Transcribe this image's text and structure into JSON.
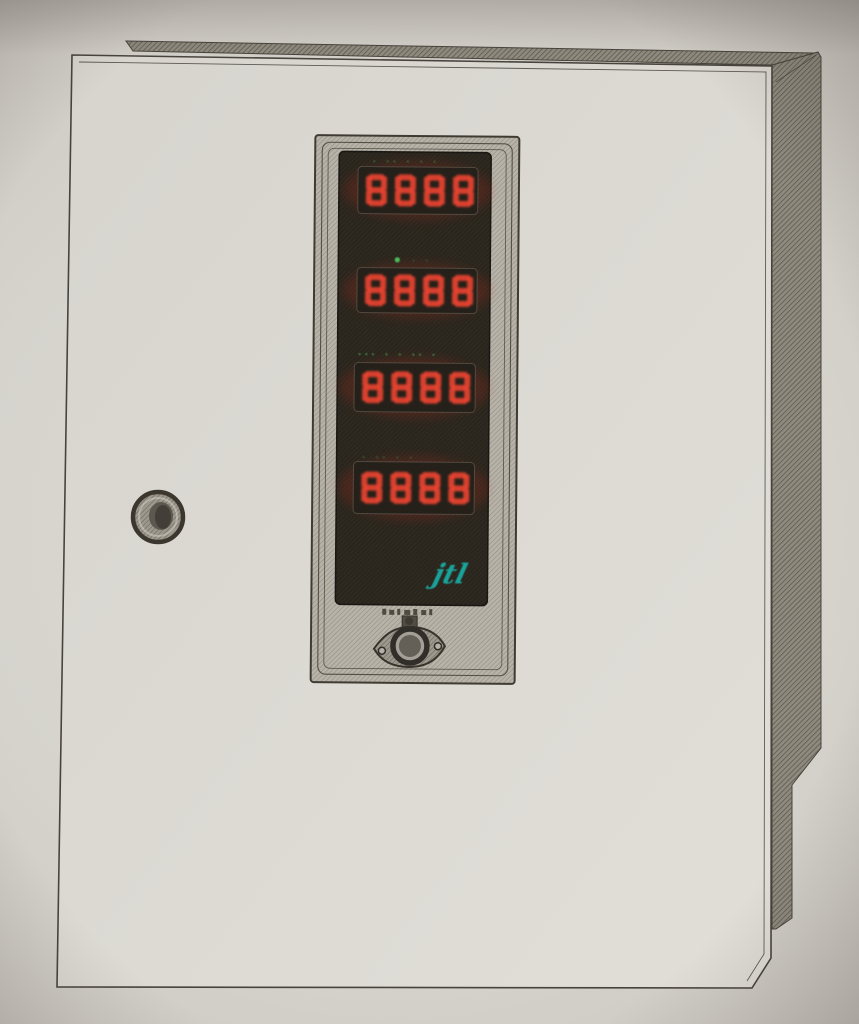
{
  "figure": {
    "subject": "wall-mounted metal enclosure with four-row LED display panel"
  },
  "colors": {
    "paper": "#d6d3cd",
    "line": "#45413a",
    "door": "#dedbd5",
    "plate_grey": "#b6b2a8",
    "window_black": "#26221a",
    "digit_red": "#e8402e",
    "digit_glow": "#c22715",
    "label_green": "#3fae52",
    "indicator_green": "#43c95d",
    "logo_teal": "#17a39b"
  },
  "display": {
    "logo": "jtl",
    "rows": [
      {
        "digits": "8888",
        "marks": "∙ ∙∙ ∙ ∙ ∙"
      },
      {
        "digits": "8888",
        "marks": "∙ ∙"
      },
      {
        "digits": "8888",
        "marks": "∙∙∙ ∙ ∙ ∙∙ ∙"
      },
      {
        "digits": "8888",
        "marks": "∙ ∙∙ ∙ ∙"
      }
    ]
  }
}
